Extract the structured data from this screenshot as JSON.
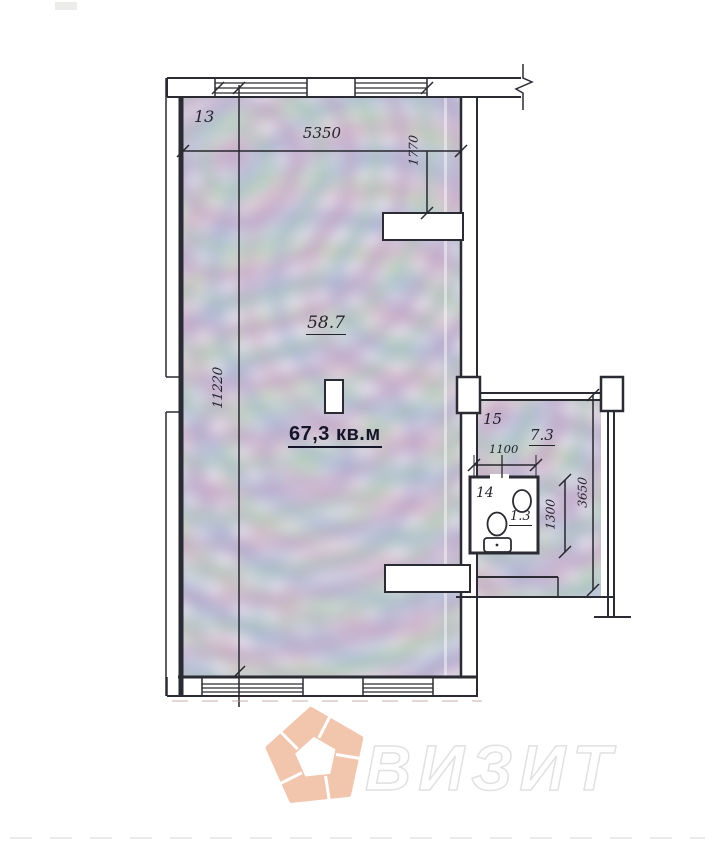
{
  "labels": {
    "room13": "13",
    "room15": "15",
    "room14": "14",
    "area_main": "58.7",
    "area_total": "67,3 кв.м",
    "area_right": "7.3",
    "area_wc": "1.3",
    "dim_top_width": "5350",
    "dim_top_right_depth": "1770",
    "dim_left_height": "11220",
    "dim_wc_width": "1100",
    "dim_wc_height": "1300",
    "dim_right_height": "3650"
  },
  "watermark": {
    "brand": "ВИЗИТ",
    "logo_color": "#f2c6ad",
    "outline_color": "#e1e1e1"
  },
  "colors": {
    "line": "#2b2b33",
    "room_fill_base": "#d8d2e2"
  }
}
